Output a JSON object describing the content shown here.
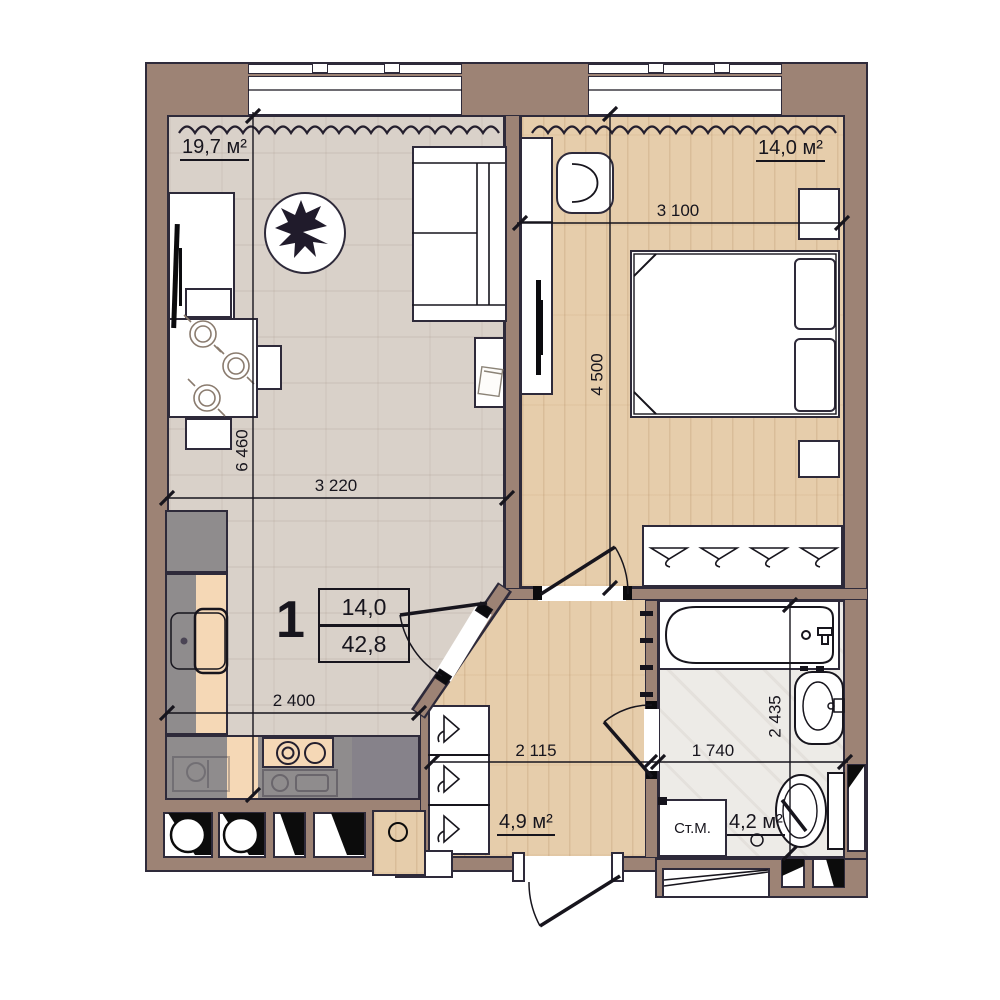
{
  "info": {
    "apartment_number": "1",
    "living_area": "14,0",
    "total_area": "42,8",
    "washer_label": "Ст.М."
  },
  "rooms": {
    "living": {
      "area_label": "19,7 м²"
    },
    "bedroom": {
      "area_label": "14,0 м²"
    },
    "hall": {
      "area_label": "4,9 м²"
    },
    "bath": {
      "area_label": "4,2 м²"
    }
  },
  "dimensions": {
    "bedroom_width": "3 100",
    "bedroom_height": "4 500",
    "living_height": "6 460",
    "living_width": "3 220",
    "kitchen_width": "2 400",
    "hall_width": "2 115",
    "bath_width": "1 740",
    "bath_height": "2 435"
  },
  "colors": {
    "wall": "#9d8375",
    "outline": "#2e2a3a",
    "floor_living": "#d9d1c9",
    "floor_wood": "#e6cdab",
    "floor_bath": "#edebe7",
    "counter_gray": "#8f8c8d",
    "counter_tan": "#f5d8b6",
    "line": "#17151d"
  }
}
